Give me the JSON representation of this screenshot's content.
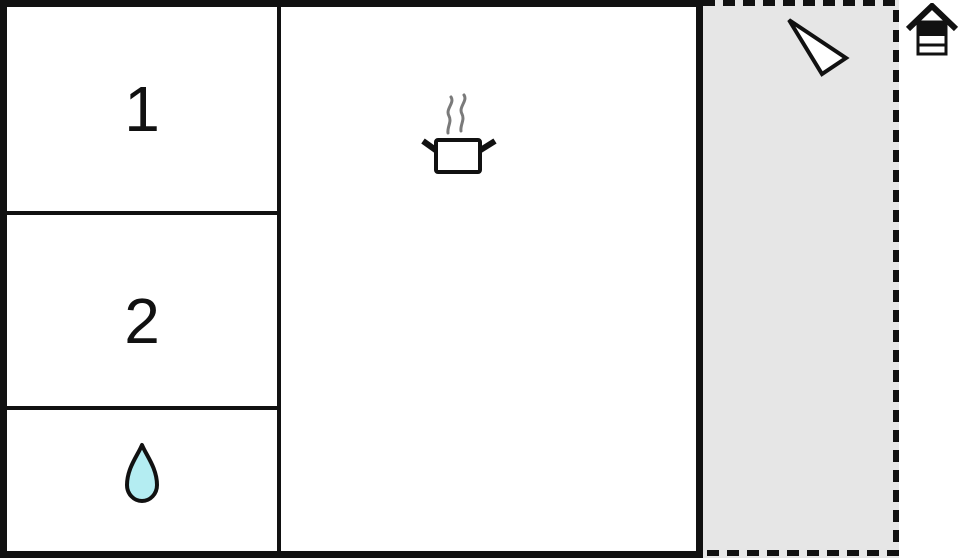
{
  "rooms": [
    {
      "label": "1"
    },
    {
      "label": "2"
    },
    {
      "label": "",
      "icon": "water-drop-icon"
    },
    {
      "label": "",
      "icon": "cooking-pot-icon"
    }
  ],
  "terrace": {
    "icon": "north-arrow-icon"
  },
  "floor_indicator": {
    "icon": "floor-level-icon",
    "highlighted_level": "top"
  },
  "colors": {
    "wall": "#111111",
    "background": "#ffffff",
    "terrace_fill": "#e6e6e6",
    "water_drop_fill": "#b4edf2",
    "steam": "#7a7a7a"
  }
}
